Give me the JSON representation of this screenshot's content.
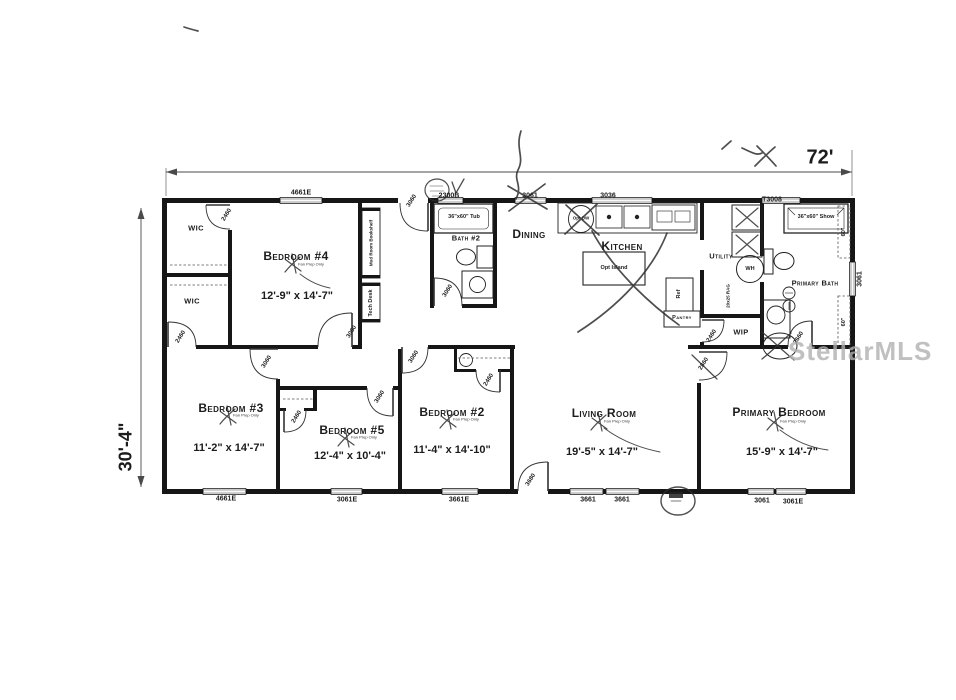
{
  "dimensions": {
    "width": "72'",
    "depth": "30'-4\""
  },
  "watermark": "StellarMLS",
  "fan_note": "Fan Prep Only",
  "rooms": {
    "bedroom4": {
      "name": "Bedroom #4",
      "size": "12'-9\" x 14'-7\""
    },
    "bedroom3": {
      "name": "Bedroom #3",
      "size": "11'-2\" x 14'-7\""
    },
    "bedroom5": {
      "name": "Bedroom #5",
      "size": "12'-4\" x 10'-4\""
    },
    "bedroom2": {
      "name": "Bedroom #2",
      "size": "11'-4\" x 14'-10\""
    },
    "living_room": {
      "name": "Living Room",
      "size": "19'-5\" x 14'-7\""
    },
    "primary_bedroom": {
      "name": "Primary Bedroom",
      "size": "15'-9\" x 14'-7\""
    },
    "dining": {
      "name": "Dining"
    },
    "kitchen": {
      "name": "Kitchen"
    },
    "utility": {
      "name": "Utility"
    },
    "primary_bath": {
      "name": "Primary Bath"
    },
    "bath2": {
      "name": "Bath #2"
    },
    "wic_top": {
      "name": "WIC"
    },
    "wic_bottom": {
      "name": "WIC"
    },
    "wip": {
      "name": "WIP"
    },
    "pantry": {
      "name": "Pantry"
    }
  },
  "features": {
    "tub": "36\"x60\" Tub",
    "shower": "36\"x60\" Show",
    "water_heater": "WH",
    "refrigerator": "Ref",
    "dishwasher": "Opt DW",
    "island": "Opt Island",
    "mud_room_shelf": "Mud Room Bookshelf",
    "tech_desk": "Tech Desk",
    "return_air": "20x25 RAG",
    "closet_rod_a": "60\"",
    "closet_rod_b": "60\""
  },
  "windows": {
    "top": [
      "4661E",
      "2300B",
      "3061",
      "3036",
      "T3008"
    ],
    "bottom": [
      "4661E",
      "3061E",
      "3661E",
      "3661",
      "3661",
      "3061",
      "3061E"
    ],
    "right": [
      "3061"
    ]
  },
  "doors": {
    "wic_top": "2460",
    "wic_bottom": "2460",
    "bedroom4": "3060",
    "entry": "3060",
    "bath2": "3060",
    "bedroom3": "3060",
    "bedroom5": "3060",
    "bedroom5_closet": "2460",
    "bedroom2": "3060",
    "bedroom2_closet": "2460",
    "living_exterior": "3680",
    "primary_bedroom": "2860",
    "wip": "2460",
    "primary_bath": "2660"
  }
}
